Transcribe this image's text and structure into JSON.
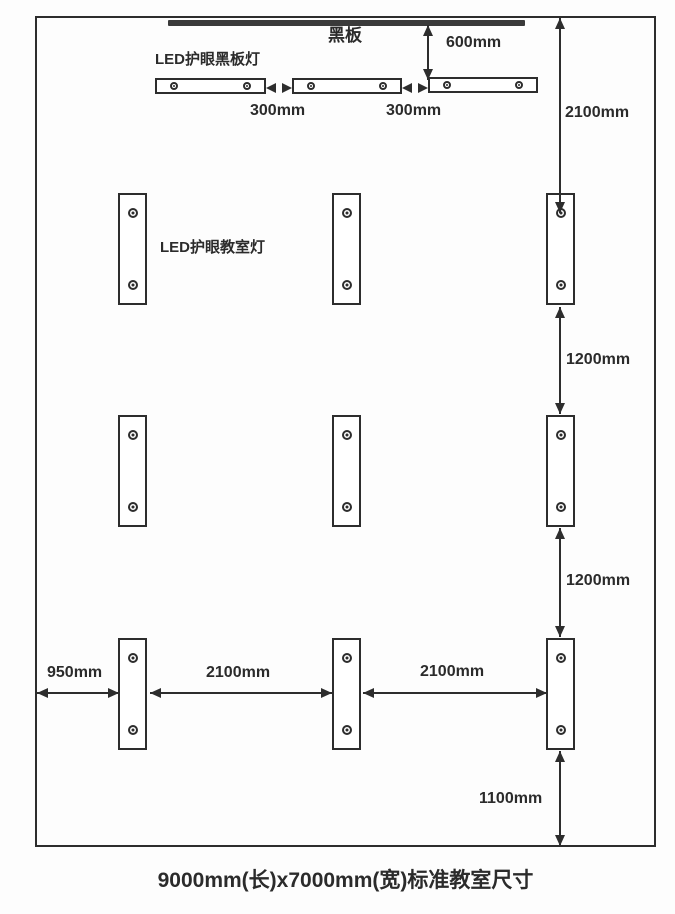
{
  "diagram": {
    "title_caption": "9000mm(长)x7000mm(宽)标准教室尺寸",
    "blackboard_label": "黑板",
    "blackboard_light_label": "LED护眼黑板灯",
    "classroom_light_label": "LED护眼教室灯",
    "dimensions": {
      "blackboard_to_light": "600mm",
      "bb_gap_1": "300mm",
      "bb_gap_2": "300mm",
      "wall_to_row1": "2100mm",
      "row1_to_row2": "1200mm",
      "row2_to_row3": "1200mm",
      "wall_to_col1": "950mm",
      "col1_to_col2": "2100mm",
      "col2_to_col3": "2100mm",
      "row3_to_wall": "1100mm"
    },
    "counts": {
      "blackboard_lights": 3,
      "classroom_lights": 9
    },
    "colors": {
      "line": "#2d2d2d",
      "text": "#2b2b2b",
      "blackboard_fill": "#3a3a3a",
      "background": "#fdfdfd"
    }
  }
}
